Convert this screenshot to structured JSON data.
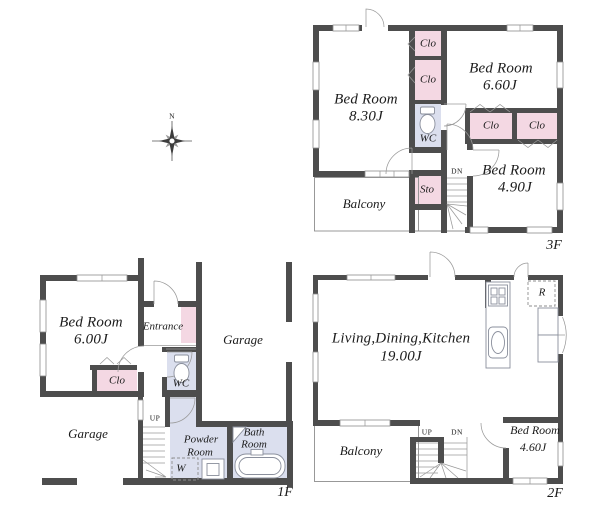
{
  "palette": {
    "wall": "#4d4d4d",
    "closet": "#f4d8e3",
    "wet": "#dbdfee",
    "line": "#8d8d8d",
    "ink": "#1b1b1b"
  },
  "compass": {
    "north": "N"
  },
  "floors": {
    "f1": {
      "label": "1F",
      "rooms": {
        "bedroom": {
          "name": "Bed Room",
          "size": "6.00J"
        },
        "entrance": {
          "label": "Entrance"
        },
        "closet": {
          "label": "Clo"
        },
        "wc": {
          "label": "WC"
        },
        "garage_right": {
          "label": "Garage"
        },
        "garage_left": {
          "label": "Garage"
        },
        "powder_room": {
          "line1": "Powder",
          "line2": "Room"
        },
        "washer": {
          "label": "W"
        },
        "bath_room": {
          "line1": "Bath",
          "line2": "Room"
        },
        "stairs": {
          "up": "UP"
        }
      }
    },
    "f2": {
      "label": "2F",
      "rooms": {
        "ldk": {
          "name": "Living,Dining,Kitchen",
          "size": "19.00J"
        },
        "refrigerator": {
          "label": "R"
        },
        "bedroom": {
          "name": "Bed Room",
          "size": "4.60J"
        },
        "balcony": {
          "label": "Balcony"
        },
        "stairs": {
          "up": "UP",
          "down": "DN"
        }
      }
    },
    "f3": {
      "label": "3F",
      "rooms": {
        "bedroom_a": {
          "name": "Bed Room",
          "size": "8.30J"
        },
        "bedroom_b": {
          "name": "Bed Room",
          "size": "6.60J"
        },
        "bedroom_c": {
          "name": "Bed Room",
          "size": "4.90J"
        },
        "closet_a": {
          "label": "Clo"
        },
        "closet_b": {
          "label": "Clo"
        },
        "closet_c": {
          "label": "Clo"
        },
        "closet_d": {
          "label": "Clo"
        },
        "wc": {
          "label": "WC"
        },
        "storage": {
          "label": "Sto"
        },
        "balcony": {
          "label": "Balcony"
        },
        "stairs": {
          "down": "DN"
        }
      }
    }
  }
}
